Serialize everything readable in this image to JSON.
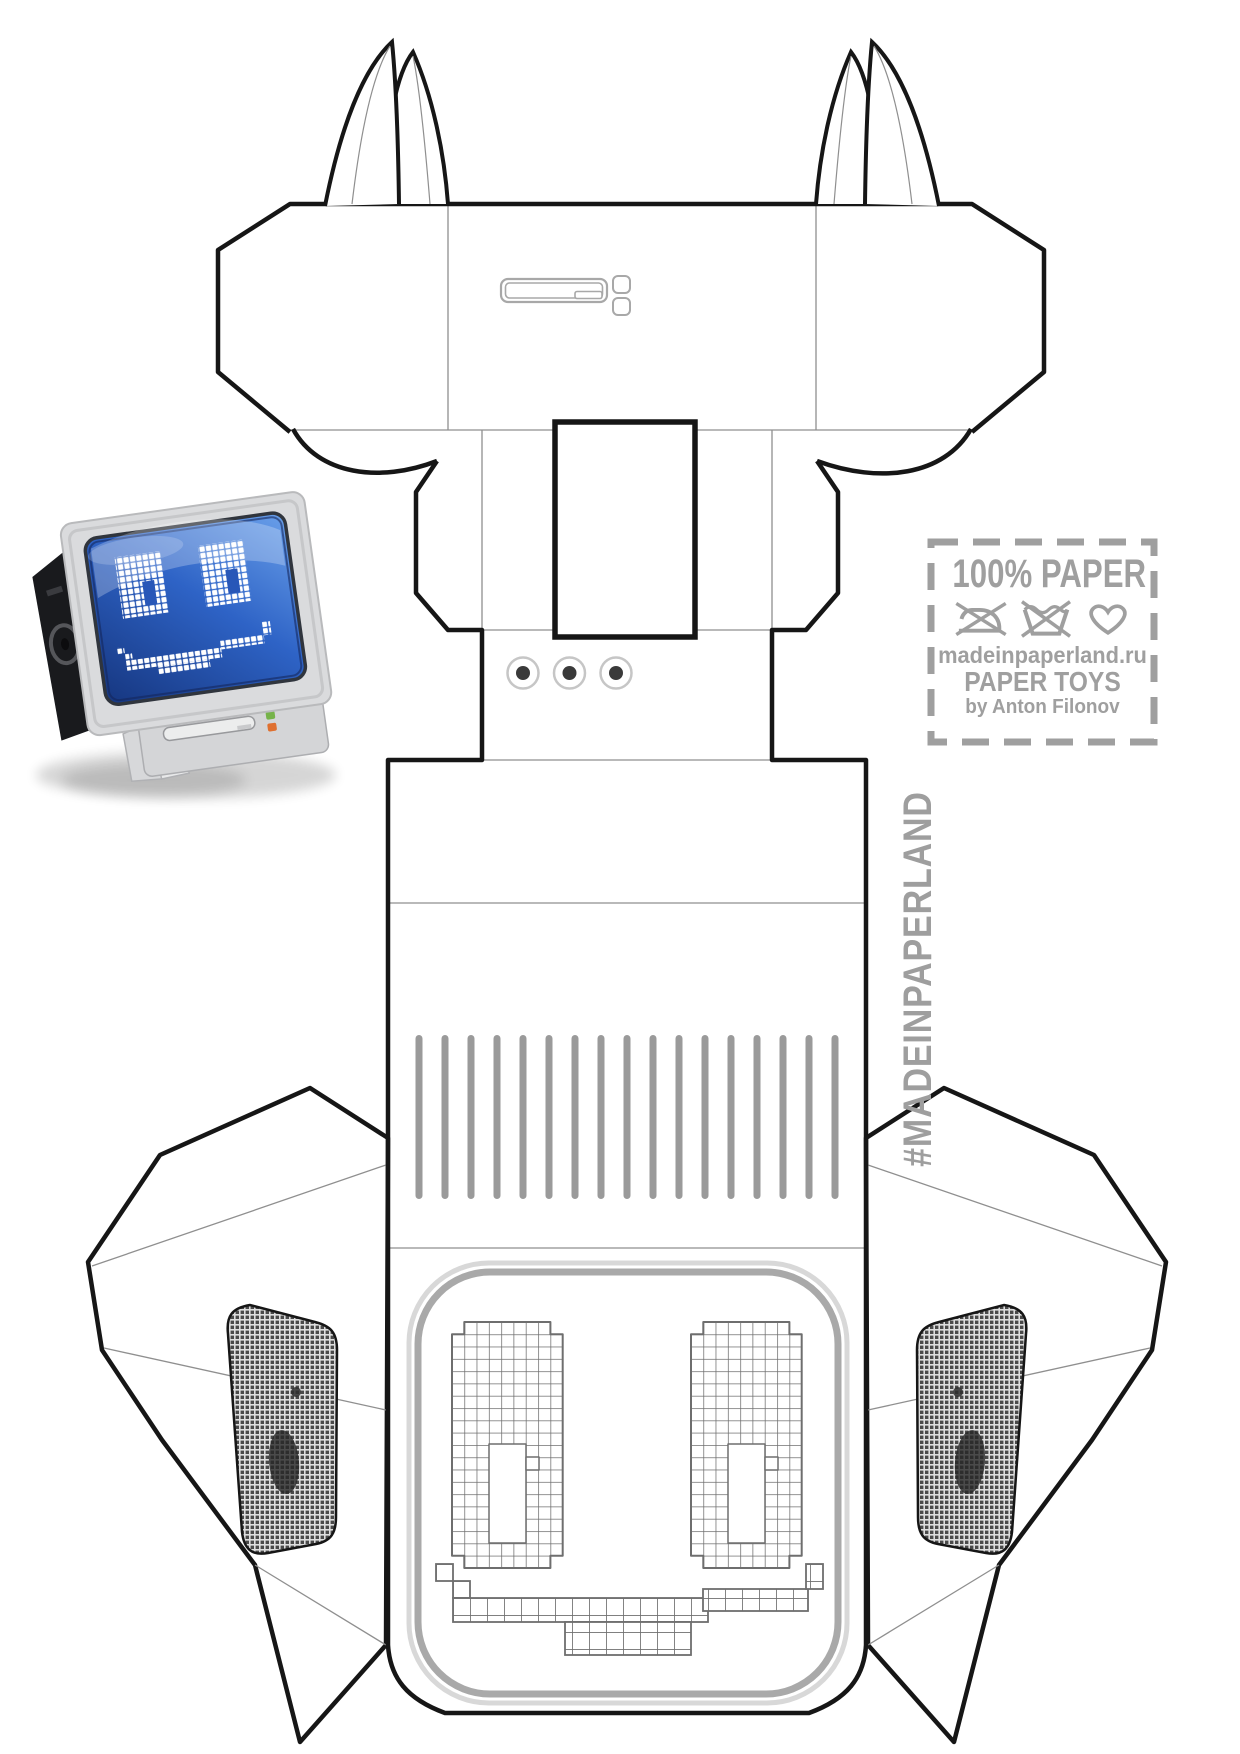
{
  "stamp": {
    "title": "100% PAPER",
    "icons": [
      "no-iron-icon",
      "no-wash-icon",
      "heart-icon"
    ],
    "website": "madeinpaperland.ru",
    "series": "PAPER TOYS",
    "author": "by Anton Filonov",
    "color": "#9f9f9f"
  },
  "watermark": {
    "hashtag": "#MADEINPAPERLAND",
    "color": "#9e9e9e"
  },
  "template": {
    "slat_count": 17,
    "screw_dot_count": 3,
    "colors": {
      "cut_line": "#161616",
      "fold_line": "#8f8f8f",
      "slat": "#9a9a9a",
      "pixel_grid": "#6e6e6e",
      "bezel": "#a9a9a9",
      "bezel_light": "#d8d8d8",
      "detail_gray": "#a8a8a8",
      "speaker_dot": "#4a4a4a"
    }
  },
  "preview": {
    "screen_color": "#2e63c6",
    "screen_color_dark": "#16367f",
    "screen_color_light": "#6aa0ea",
    "pixel_color": "#ffffff",
    "shell_color": "#dadbdd",
    "speaker_panel_color": "#191a1d",
    "button_colors": [
      "#76b34a",
      "#df7030"
    ]
  }
}
